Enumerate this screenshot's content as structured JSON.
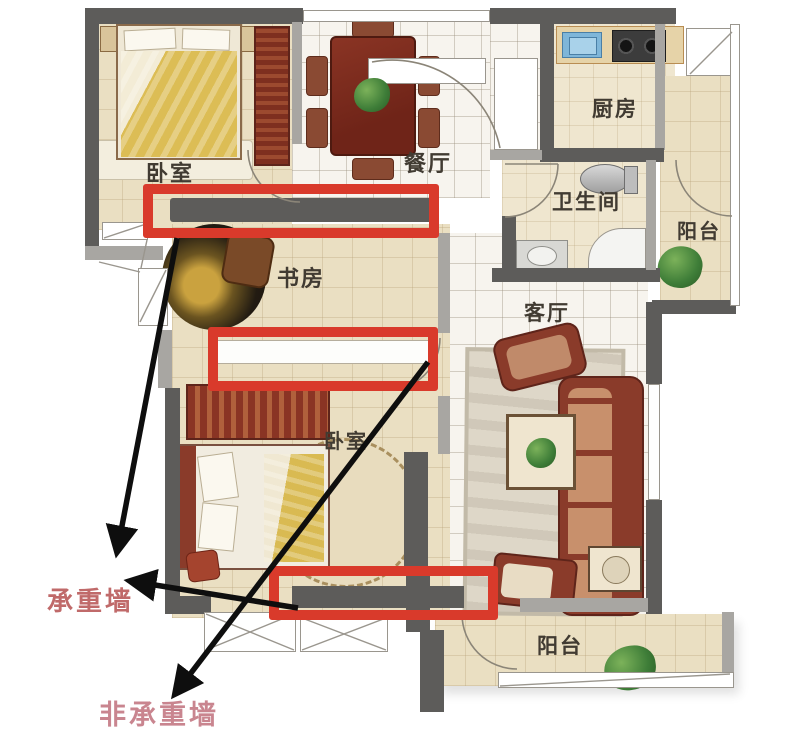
{
  "plan": {
    "type": "apartment-floor-plan-annotation",
    "rooms": [
      {
        "id": "bedroom-top",
        "label": "卧室"
      },
      {
        "id": "dining",
        "label": "餐厅"
      },
      {
        "id": "kitchen",
        "label": "厨房"
      },
      {
        "id": "bathroom",
        "label": "卫生间"
      },
      {
        "id": "balcony-top",
        "label": "阳台"
      },
      {
        "id": "study",
        "label": "书房"
      },
      {
        "id": "living",
        "label": "客厅"
      },
      {
        "id": "bedroom-bottom",
        "label": "卧室"
      },
      {
        "id": "balcony-bottom",
        "label": "阳台"
      }
    ],
    "annotations": {
      "load_bearing": {
        "label": "承重墙",
        "color": "#c06a6a",
        "arrow_count": 2
      },
      "non_load_bearing": {
        "label": "非承重墙",
        "color": "#c9858f",
        "arrow_count": 1
      }
    },
    "highlights": {
      "count": 3,
      "color": "#d93a2b"
    }
  },
  "palette": {
    "wall_dark": "#5d5c5a",
    "wall_light": "#a8a6a2",
    "floor_beige": "#eadfc2",
    "floor_tile": "#f7f4ee",
    "furniture_red": "#8a3b2a",
    "accent_gold": "#d9ba52",
    "plant_green": "#3e7d38",
    "highlight_red": "#d93a2b",
    "arrow_black": "#0e0e0e"
  }
}
